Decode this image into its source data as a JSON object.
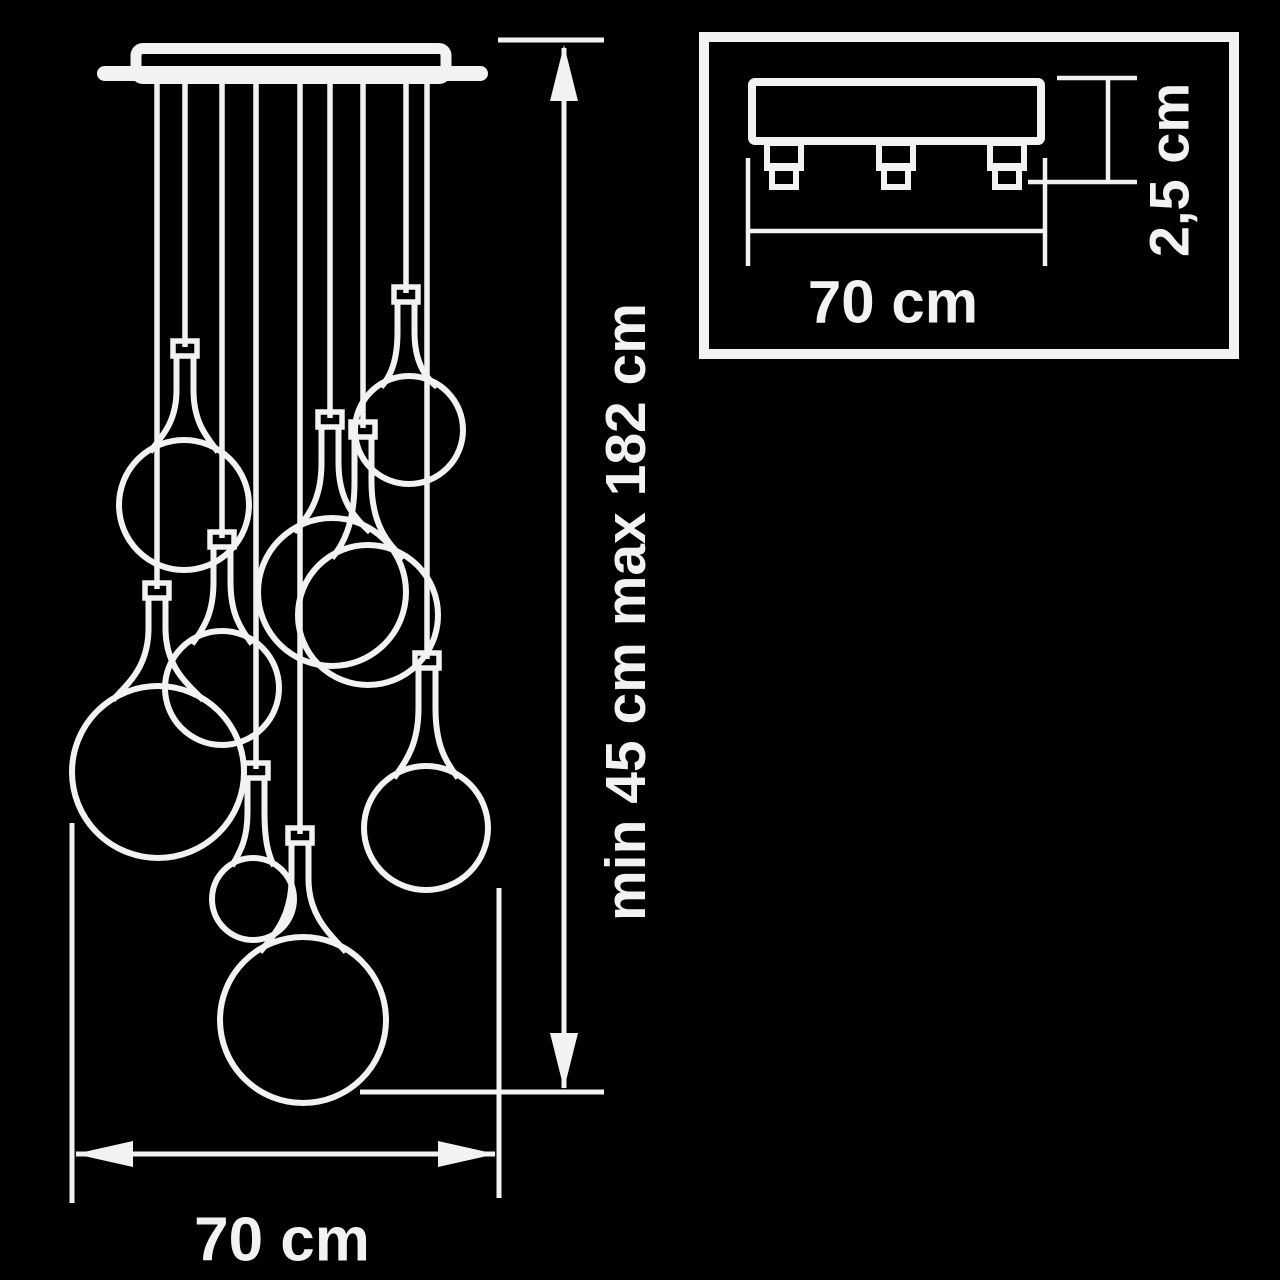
{
  "diagram": {
    "type": "technical-dimension-drawing",
    "background_color": "#000000",
    "line_color": "#f2f2f2",
    "main_view": {
      "subject": "cascade pendant chandelier, front view",
      "pendant_count": 9,
      "height_dimension_label": "min 45 cm max 182 cm",
      "width_dimension_label": "70 cm"
    },
    "detail_view": {
      "subject": "ceiling mount plate, side view",
      "connector_count": 3,
      "width_dimension_label": "70 cm",
      "height_dimension_label": "2,5 cm"
    }
  }
}
